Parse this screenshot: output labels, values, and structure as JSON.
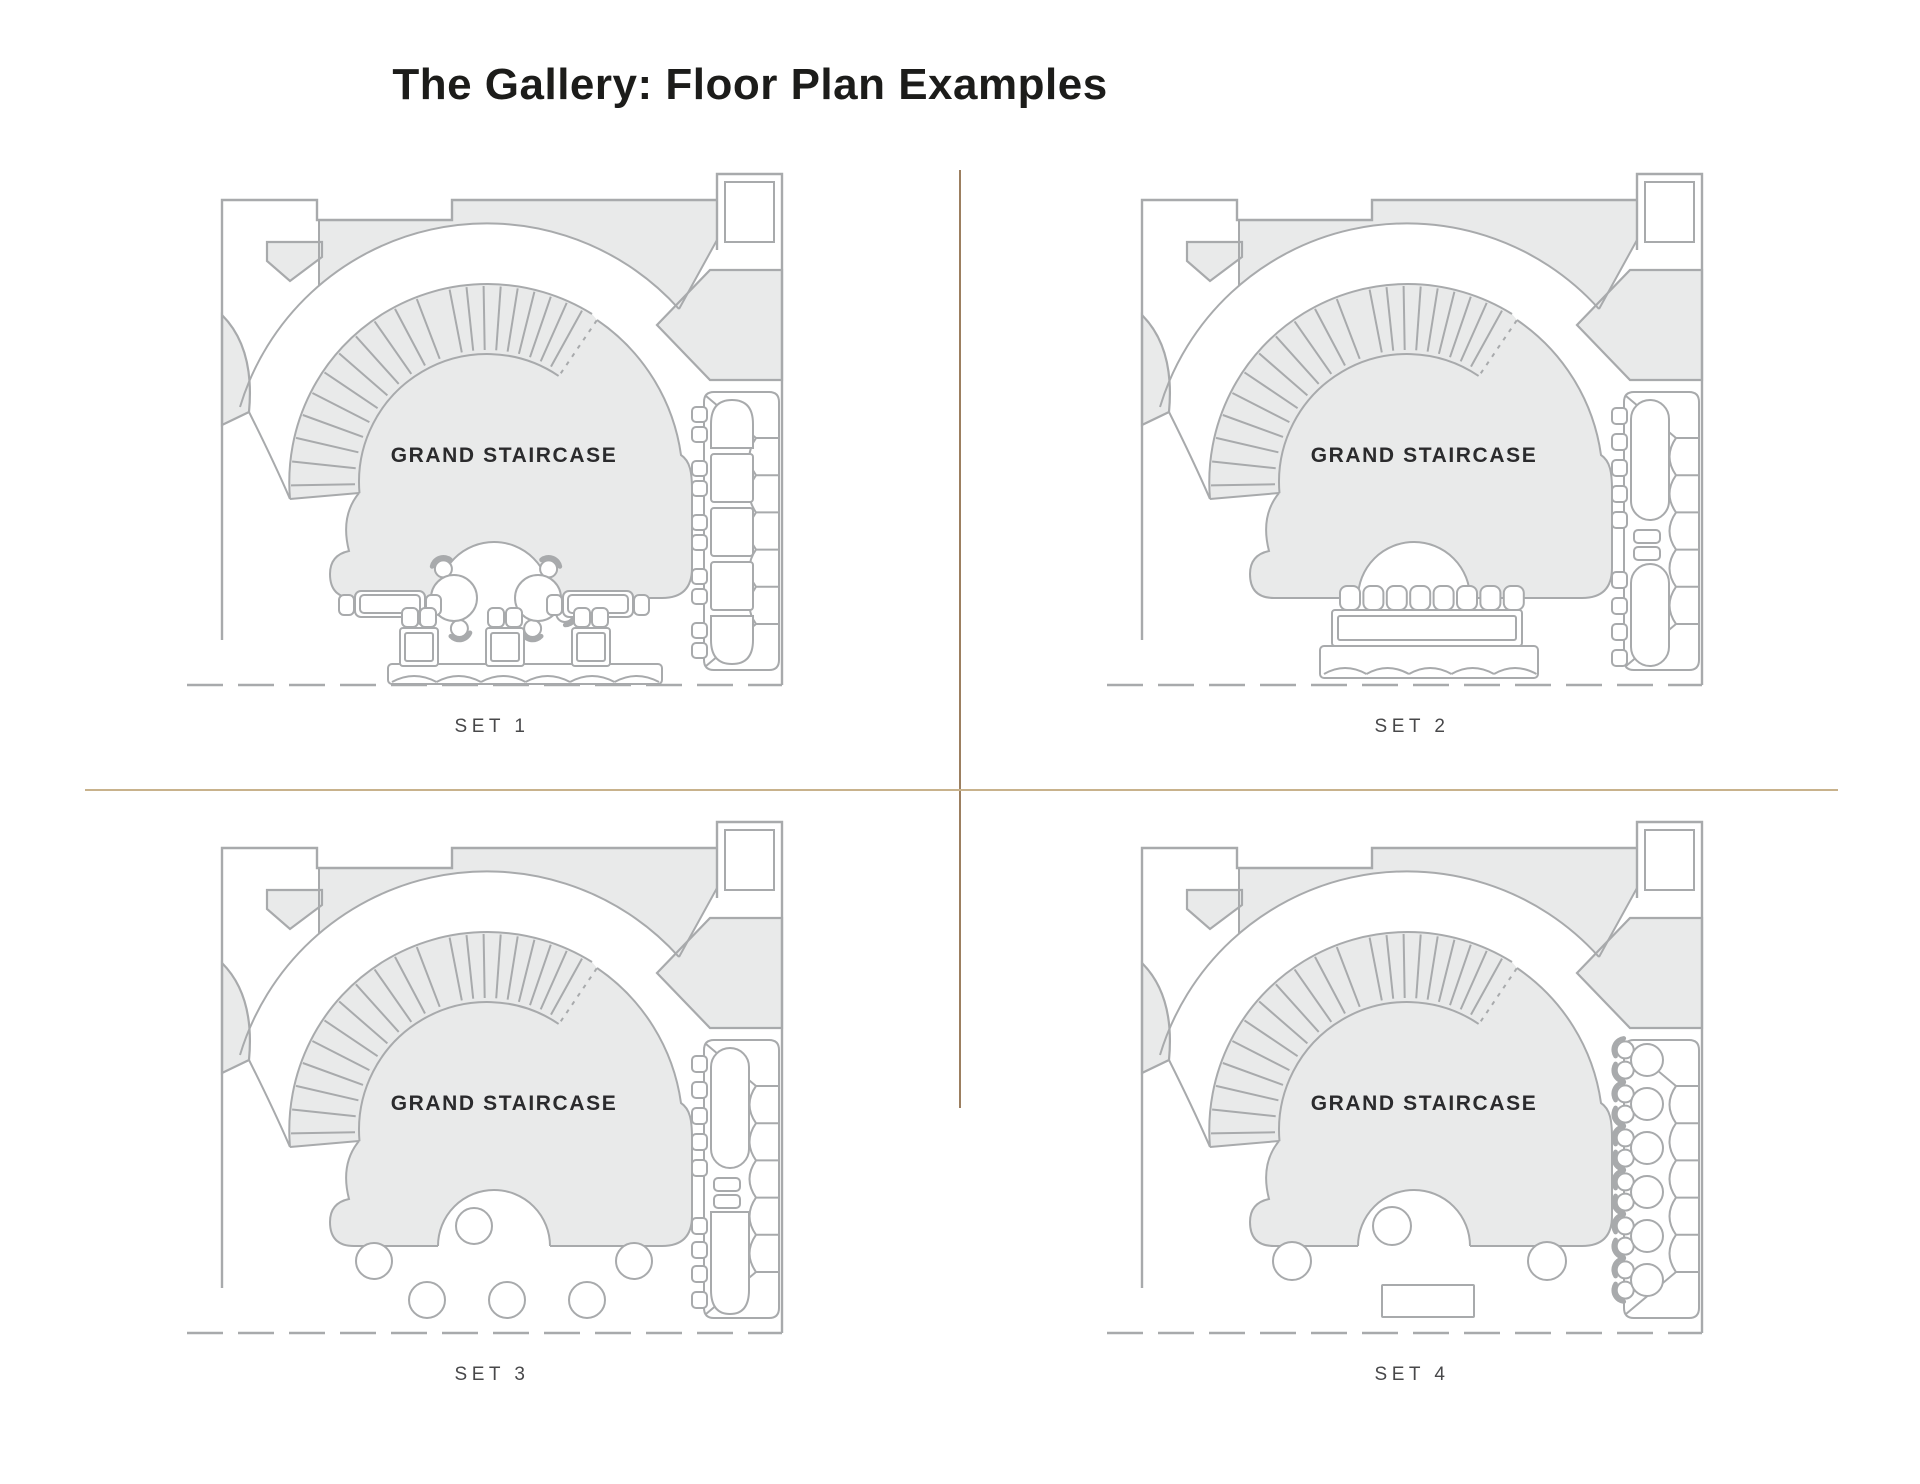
{
  "page": {
    "title": "The Gallery: Floor Plan Examples",
    "background": "#ffffff"
  },
  "staircase_label": "GRAND STAIRCASE",
  "sets": [
    {
      "id": 1,
      "label": "SET 1",
      "variant": "lounge",
      "description": "Two round cocktail tables in staircase arch, two side tables with end chairs, three sofa-table units on banquette, five-table banquette seating on right wall"
    },
    {
      "id": 2,
      "label": "SET 2",
      "variant": "conference",
      "description": "Long conference table with eight chairs on bottom banquette, two long tables with chairs along right banquette"
    },
    {
      "id": 3,
      "label": "SET 3",
      "variant": "cocktail",
      "description": "Six round cocktail tables on open floor, two long tables with chairs along right banquette"
    },
    {
      "id": 4,
      "label": "SET 4",
      "variant": "cocktail-bar",
      "description": "Three round cocktail tables, rectangular bar table at bottom, six round tables with chairs along right banquette"
    }
  ],
  "colors": {
    "plan_fill": "#e9eaea",
    "plan_line": "#a8aaac",
    "text_dark": "#2b2b2d",
    "label_text": "#48484a",
    "divider_vertical": "#9c7f60",
    "divider_horizontal": "#c8b28c"
  }
}
